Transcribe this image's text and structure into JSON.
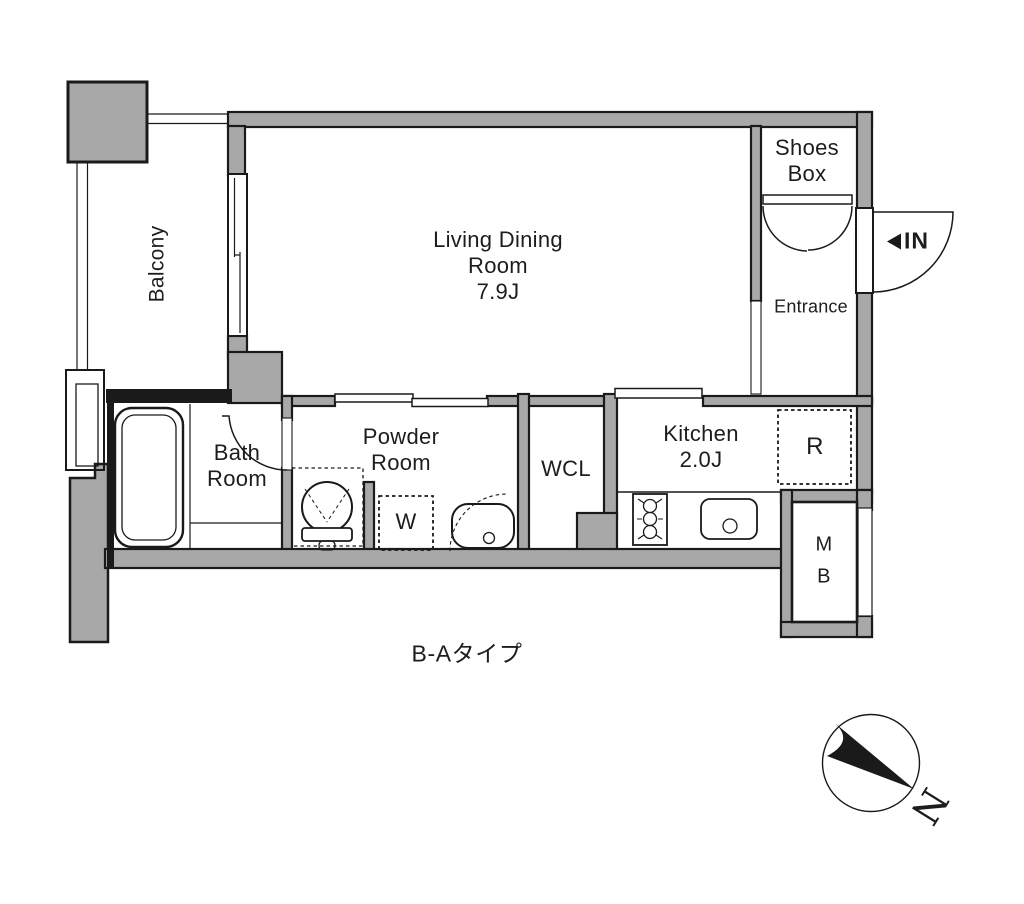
{
  "plan": {
    "title": "B-Aタイプ",
    "compass_label": "N",
    "rooms": {
      "balcony": {
        "label": "Balcony"
      },
      "living": {
        "label": "Living Dining\nRoom\n7.9J"
      },
      "shoes_box": {
        "label": "Shoes\nBox"
      },
      "entrance": {
        "label": "Entrance"
      },
      "entry_in": {
        "label": "IN"
      },
      "bath": {
        "label": "Bath\nRoom"
      },
      "powder": {
        "label": "Powder\nRoom"
      },
      "wcl": {
        "label": "WCL"
      },
      "washer": {
        "label": "W"
      },
      "kitchen": {
        "label": "Kitchen\n2.0J"
      },
      "refrigerator": {
        "label": "R"
      },
      "meter_box": {
        "label": "M\nB"
      }
    },
    "colors": {
      "wall_fill": "#a8a8a8",
      "line": "#1a1a1a",
      "text": "#1d1d1d",
      "background": "#ffffff"
    }
  }
}
